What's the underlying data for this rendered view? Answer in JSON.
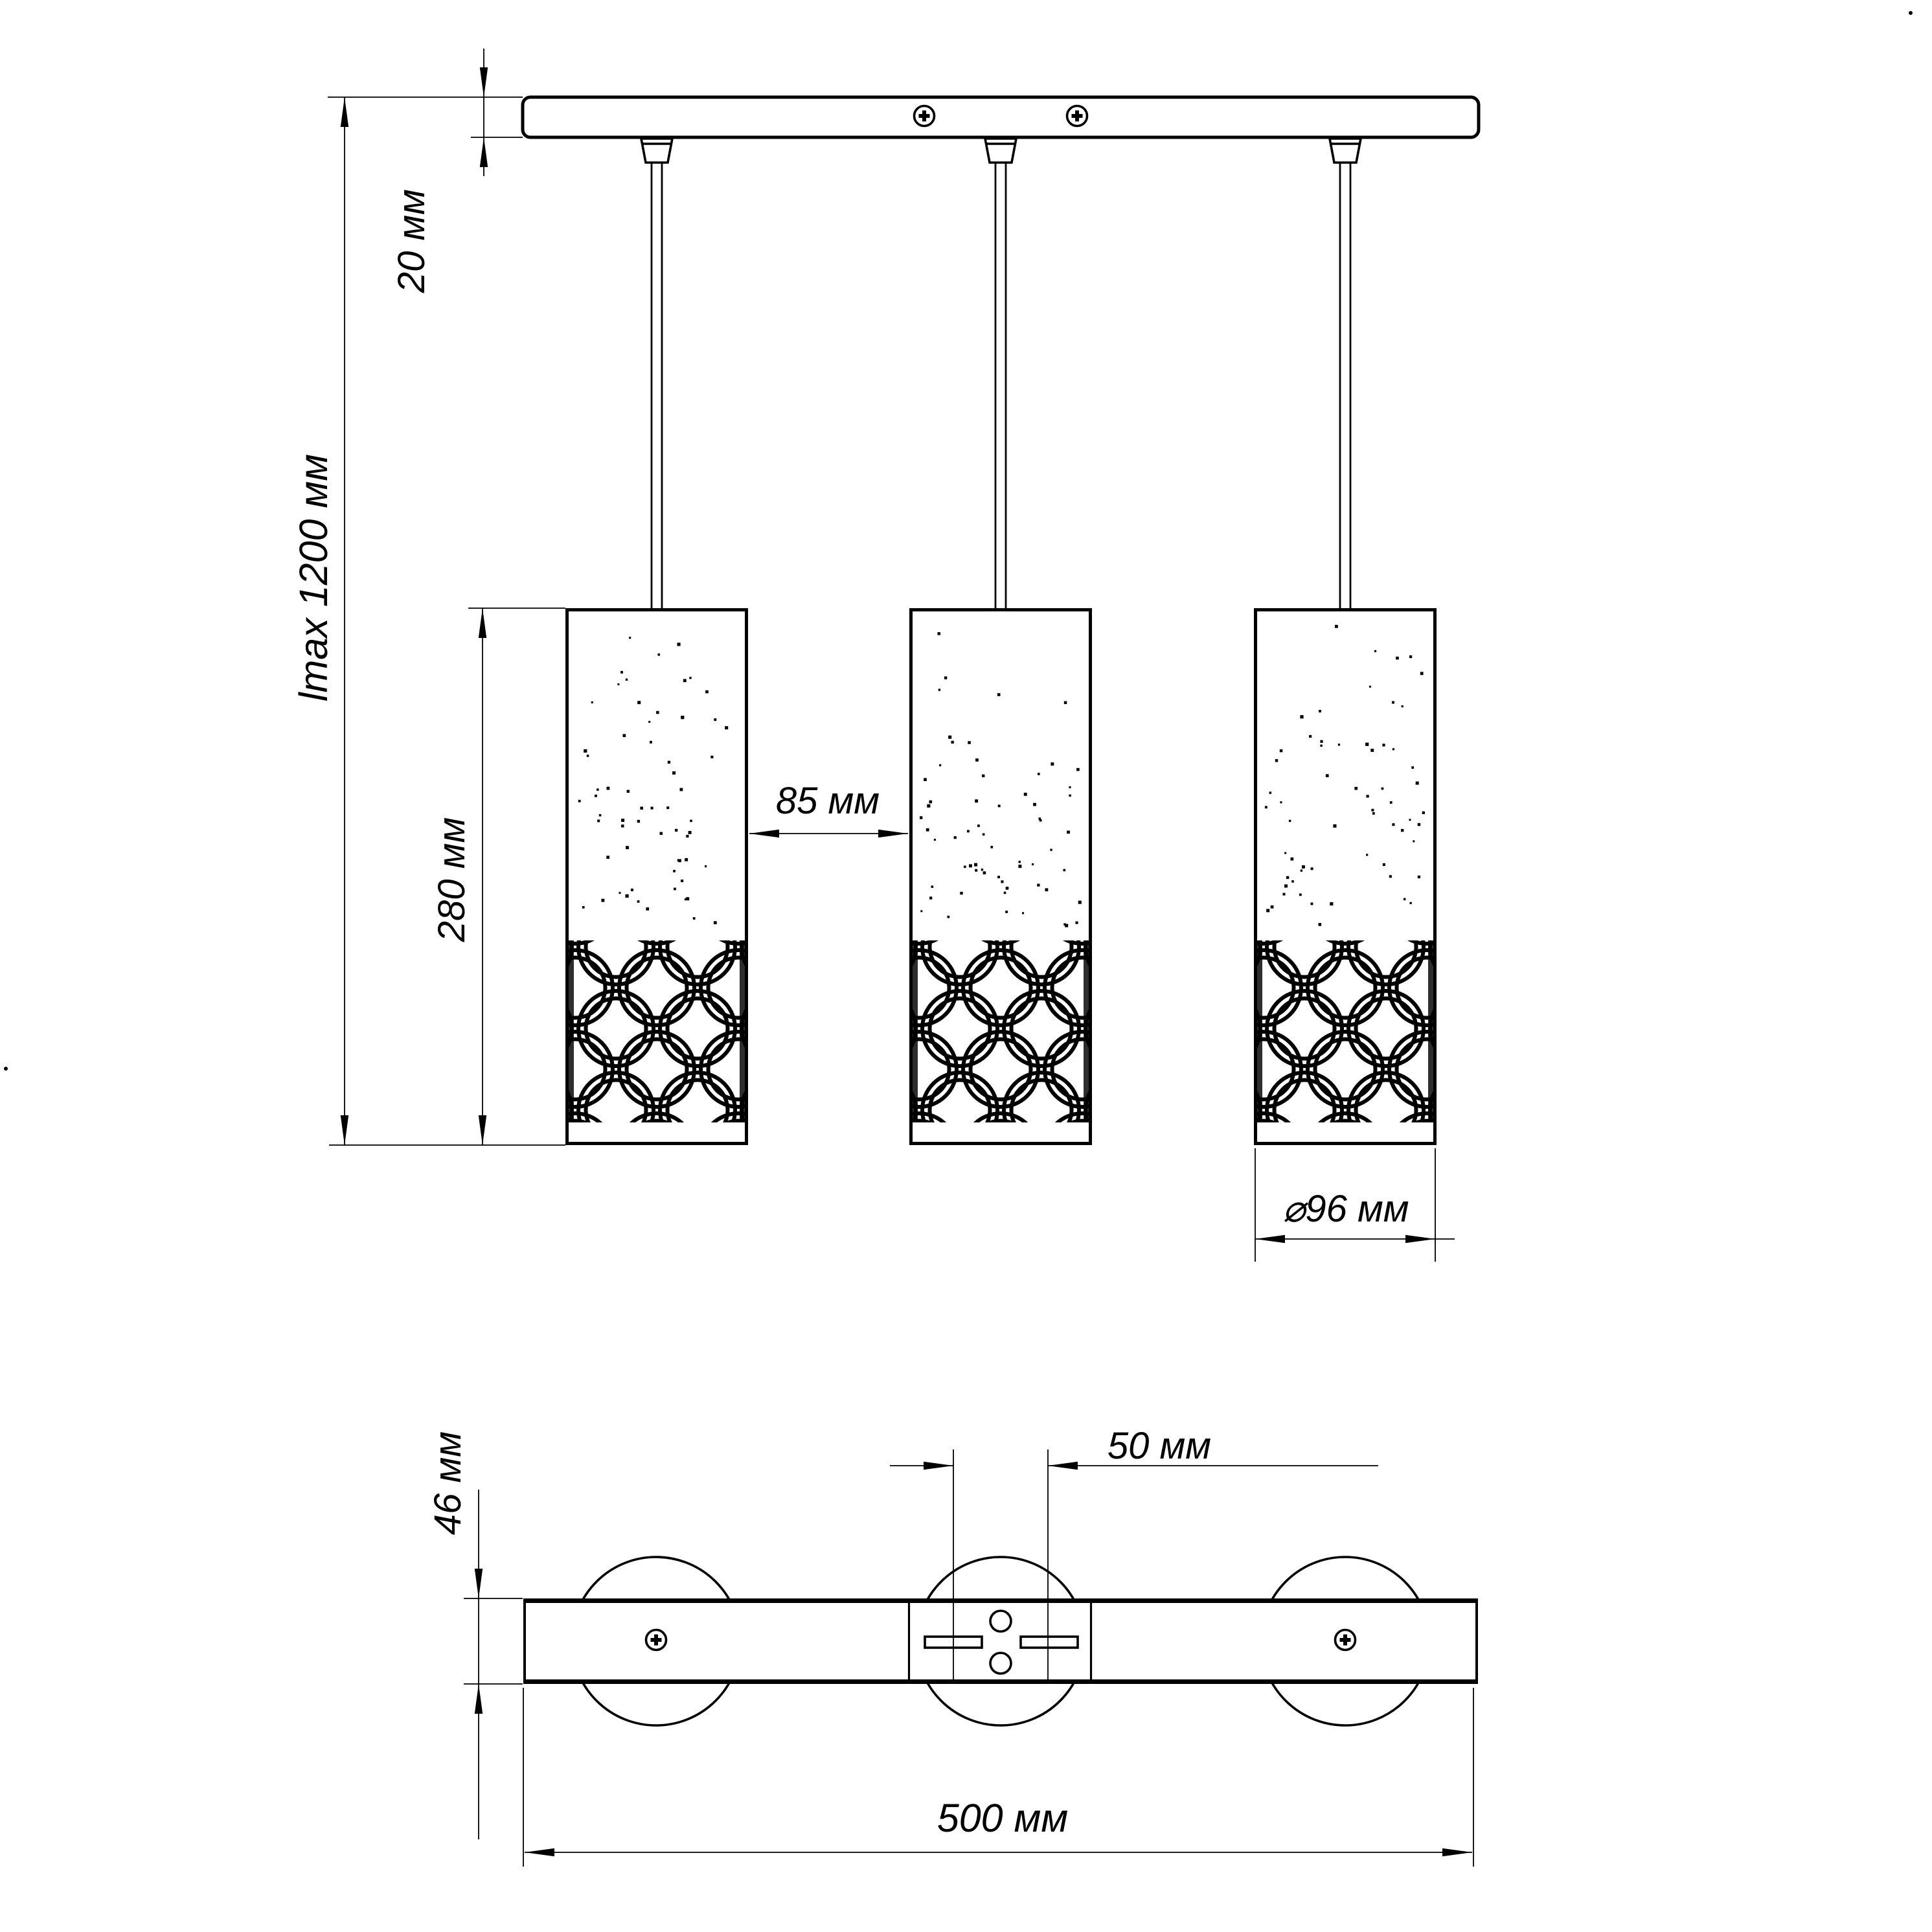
{
  "colors": {
    "ink": "#000000",
    "background": "#ffffff"
  },
  "front_view": {
    "labels": {
      "canopy_thickness": "20 мм",
      "max_length": "lmax 1200 мм",
      "shade_height": "280 мм",
      "shade_gap": "85 мм",
      "shade_diameter": "⌀96 мм"
    }
  },
  "bottom_view": {
    "labels": {
      "canopy_depth": "46 мм",
      "slot_spacing": "50 мм",
      "canopy_length": "500 мм"
    }
  }
}
